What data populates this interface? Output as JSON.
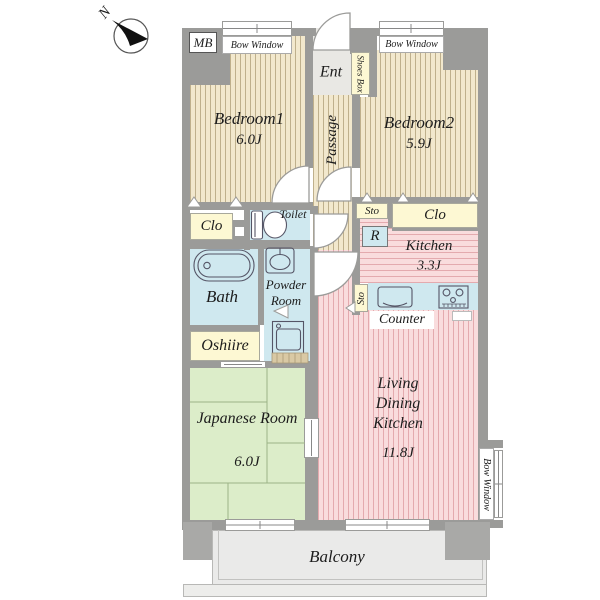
{
  "compass": {
    "north": "N"
  },
  "labels": {
    "mb": "MB",
    "bow_window": "Bow Window",
    "ent": "Ent",
    "shoes_box": "Shoes Box",
    "passage": "Passage",
    "clo": "Clo",
    "sto": "Sto",
    "toilet": "Toilet",
    "bath": "Bath",
    "powder_room": "Powder Room",
    "refrigerator": "R",
    "counter": "Counter",
    "oshiire": "Oshiire",
    "balcony": "Balcony"
  },
  "rooms": {
    "bedroom1": {
      "name": "Bedroom1",
      "size": "6.0J"
    },
    "bedroom2": {
      "name": "Bedroom2",
      "size": "5.9J"
    },
    "kitchen": {
      "name": "Kitchen",
      "size": "3.3J"
    },
    "japanese_room": {
      "name": "Japanese Room",
      "size": "6.0J"
    },
    "ldk": {
      "name": "Living Dining Kitchen",
      "size": "11.8J"
    }
  },
  "colors": {
    "wall": "#9b9b99",
    "bedroom_floor": "#f2e8cd",
    "ldk_floor": "#f9dcdd",
    "tatami_floor": "#dcedc9",
    "wet_area_floor": "#cfe8ef",
    "storage": "#fdf8d3"
  }
}
